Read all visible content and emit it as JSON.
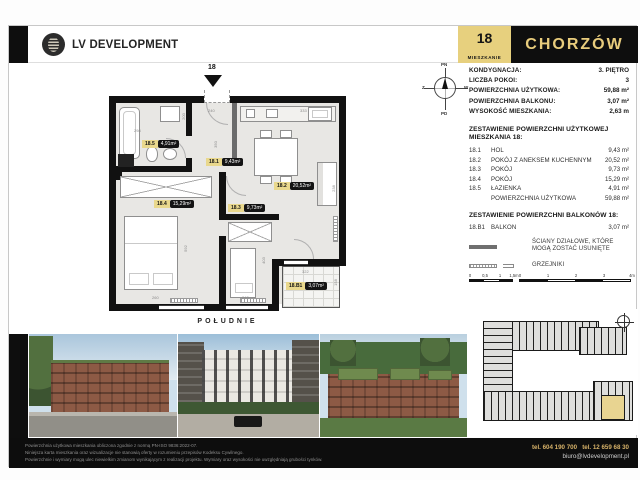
{
  "header": {
    "brand": "LV DEVELOPMENT",
    "unit_number": "18",
    "unit_label": "MIESZKANIE",
    "city": "CHORZÓW"
  },
  "summary": {
    "rows": [
      {
        "label": "KONDYGNACJA:",
        "value": "3. PIĘTRO"
      },
      {
        "label": "LICZBA POKOI:",
        "value": "3"
      },
      {
        "label": "POWIERZCHNIA UŻYTKOWA:",
        "value": "59,88 m²"
      },
      {
        "label": "POWIERZCHNIA BALKONU:",
        "value": "3,07 m²"
      },
      {
        "label": "WYSOKOŚĆ MIESZKANIA:",
        "value": "2,63 m"
      }
    ]
  },
  "usable_table": {
    "title_line1": "ZESTAWIENIE POWIERZCHNI UŻYTKOWEJ",
    "title_line2": "MIESZKANIA 18:",
    "rows": [
      {
        "id": "18.1",
        "name": "HOL",
        "area": "9,43 m²"
      },
      {
        "id": "18.2",
        "name": "POKÓJ Z ANEKSEM KUCHENNYM",
        "area": "20,52 m²"
      },
      {
        "id": "18.3",
        "name": "POKÓJ",
        "area": "9,73 m²"
      },
      {
        "id": "18.4",
        "name": "POKÓJ",
        "area": "15,29 m²"
      },
      {
        "id": "18.5",
        "name": "ŁAZIENKA",
        "area": "4,91 m²"
      }
    ],
    "total_label": "POWIERZCHNIA UŻYTKOWA",
    "total_value": "59,88 m²"
  },
  "balcony_table": {
    "title": "ZESTAWIENIE POWIERZCHNI BALKONÓW 18:",
    "rows": [
      {
        "id": "18.B1",
        "name": "BALKON",
        "area": "3,07 m²"
      }
    ]
  },
  "legend": {
    "walls_line1": "ŚCIANY DZIAŁOWE, KTÓRE",
    "walls_line2": "MOGĄ ZOSTAĆ USUNIĘTE",
    "heaters": "GRZEJNIKI",
    "scale1": [
      "0",
      "0,5",
      "1",
      "1,5m"
    ],
    "scale2": [
      "0",
      "1",
      "2",
      "3",
      "4m"
    ]
  },
  "plan": {
    "entry_label": "18",
    "south_label": "POŁUDNIE",
    "compass": {
      "n": "PN",
      "s": "PD",
      "w": "Z",
      "e": "W"
    },
    "rooms": [
      {
        "id": "18.5",
        "area": "4,91m²"
      },
      {
        "id": "18.1",
        "area": "9,43m²"
      },
      {
        "id": "18.2",
        "area": "20,52m²"
      },
      {
        "id": "18.4",
        "area": "15,29m²"
      },
      {
        "id": "18.3",
        "area": "9,73m²"
      },
      {
        "id": "18.B1",
        "area": "3,07m²"
      }
    ],
    "dims": [
      "298",
      "240",
      "333",
      "200",
      "350",
      "592",
      "238",
      "260",
      "243",
      "403",
      "322",
      "158"
    ]
  },
  "footer": {
    "disclaimer": [
      "Powierzchnia użytkowa mieszkania obliczona zgodnie z normą PN-ISO 9836:2022-07.",
      "Niniejsza karta mieszkania oraz wizualizacje nie stanowią oferty w rozumieniu przepisów Kodeksu Cywilnego.",
      "Powierzchnie i wymiary mogą ulec niewielkim zmianom wynikającym z realizacji projektu. Wymiary oraz wysokości nie uwzględniają grubości tynków."
    ],
    "phone1": "tel. 604 190 700",
    "phone2": "tel. 12 659 68 30",
    "email": "biuro@lvdevelopment.pl"
  },
  "colors": {
    "gold": "#e7d07e",
    "black": "#0e0e0e",
    "floor_gray": "#e8e7e4"
  }
}
